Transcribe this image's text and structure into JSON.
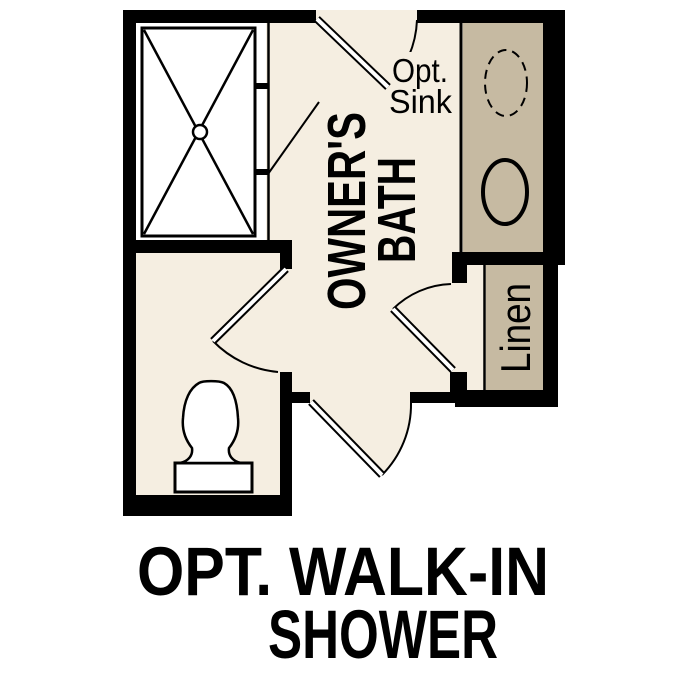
{
  "plan": {
    "room_label": {
      "line1": "OWNER'S",
      "line2": "BATH"
    },
    "sink_note": {
      "line1": "Opt.",
      "line2": "Sink"
    },
    "linen_label": "Linen",
    "caption": {
      "line1": "OPT. WALK-IN",
      "line2": "SHOWER"
    },
    "fixtures": [
      "walk-in-shower",
      "shower-drain",
      "optional-sink",
      "sink",
      "vanity-counter",
      "toilet",
      "linen-closet"
    ],
    "door_count": 4
  },
  "colors": {
    "background": "#ffffff",
    "floor": "#f5eee1",
    "cabinet": "#c6baa2",
    "water": "#a8c8e8",
    "wall": "#000000",
    "text": "#000000"
  }
}
